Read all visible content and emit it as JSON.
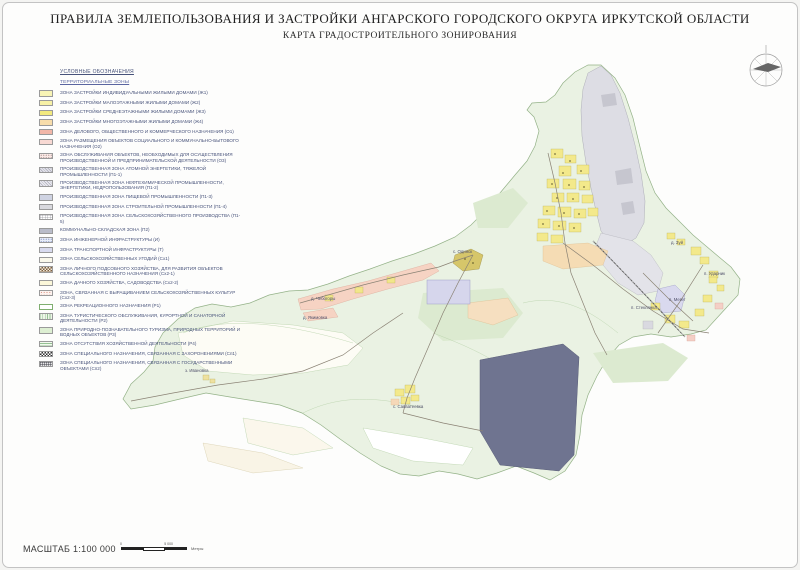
{
  "title": {
    "line1": "ПРАВИЛА ЗЕМЛЕПОЛЬЗОВАНИЯ И ЗАСТРОЙКИ АНГАРСКОГО ГОРОДСКОГО ОКРУГА ИРКУТСКОЙ ОБЛАСТИ",
    "line2": "КАРТА ГРАДОСТРОИТЕЛЬНОГО ЗОНИРОВАНИЯ"
  },
  "legend": {
    "heading": "УСЛОВНЫЕ ОБОЗНАЧЕНИЯ",
    "subheading": "ТЕРРИТОРИАЛЬНЫЕ ЗОНЫ",
    "items": [
      {
        "label": "ЗОНА ЗАСТРОЙКИ ИНДИВИДУАЛЬНЫМИ ЖИЛЫМИ ДОМАМИ (Ж1)",
        "color": "#f8f4b5",
        "pattern": "solid"
      },
      {
        "label": "ЗОНА ЗАСТРОЙКИ МАЛОЭТАЖНЫМИ ЖИЛЫМИ ДОМАМИ (Ж2)",
        "color": "#f7f1a6",
        "pattern": "solid"
      },
      {
        "label": "ЗОНА ЗАСТРОЙКИ СРЕДНЕЭТАЖНЫМИ ЖИЛЫМИ ДОМАМИ (Ж3)",
        "color": "#f2e97e",
        "pattern": "solid"
      },
      {
        "label": "ЗОНА ЗАСТРОЙКИ МНОГОЭТАЖНЫМИ ЖИЛЫМИ ДОМАМИ (Ж4)",
        "color": "#f7ddab",
        "pattern": "solid"
      },
      {
        "label": "ЗОНА ДЕЛОВОГО, ОБЩЕСТВЕННОГО И КОММЕРЧЕСКОГО НАЗНАЧЕНИЯ (О1)",
        "color": "#f2b7a8",
        "pattern": "solid"
      },
      {
        "label": "ЗОНА РАЗМЕЩЕНИЯ ОБЪЕКТОВ СОЦИАЛЬНОГО И КОММУНАЛЬНО-БЫТОВОГО НАЗНАЧЕНИЯ (О2)",
        "color": "#f8d9d3",
        "pattern": "solid"
      },
      {
        "label": "ЗОНА ОБСЛУЖИВАНИЯ ОБЪЕКТОВ, НЕОБХОДИМЫХ ДЛЯ ОСУЩЕСТВЛЕНИЯ ПРОИЗВОДСТВЕННОЙ И ПРЕДПРИНИМАТЕЛЬСКОЙ ДЕЯТЕЛЬНОСТИ (О3)",
        "color": "#fbeae6",
        "pattern": "dots"
      },
      {
        "label": "ПРОИЗВОДСТВЕННАЯ ЗОНА АТОМНОЙ ЭНЕРГЕТИКИ, ТЯЖЕЛОЙ ПРОМЫШЛЕННОСТИ (П1-1)",
        "color": "#e3e3ea",
        "pattern": "hatch"
      },
      {
        "label": "ПРОИЗВОДСТВЕННАЯ ЗОНА НЕФТЕХИМИЧЕСКОЙ ПРОМЫШЛЕННОСТИ, ЭНЕРГЕТИКИ, НЕДРОПОЛЬЗОВАНИЯ (П1-2)",
        "color": "#e9e9ef",
        "pattern": "hatch"
      },
      {
        "label": "ПРОИЗВОДСТВЕННАЯ ЗОНА ПИЩЕВОЙ ПРОМЫШЛЕННОСТИ (П1-3)",
        "color": "#cfd3e2",
        "pattern": "solid"
      },
      {
        "label": "ПРОИЗВОДСТВЕННАЯ ЗОНА СТРОИТЕЛЬНОЙ ПРОМЫШЛЕННОСТИ (П1-4)",
        "color": "#d9d9de",
        "pattern": "solid"
      },
      {
        "label": "ПРОИЗВОДСТВЕННАЯ ЗОНА СЕЛЬСКОХОЗЯЙСТВЕННОГО ПРОИЗВОДСТВА (П1-5)",
        "color": "#ffffff",
        "pattern": "grid"
      },
      {
        "label": "КОММУНАЛЬНО-СКЛАДСКАЯ ЗОНА (П2)",
        "color": "#b9bcc9",
        "pattern": "solid"
      },
      {
        "label": "ЗОНА ИНЖЕНЕРНОЙ ИНФРАСТРУКТУРЫ (И)",
        "color": "#e8edf8",
        "pattern": "dots-blue"
      },
      {
        "label": "ЗОНА ТРАНСПОРТНОЙ ИНФРАСТРУКТУРЫ (Т)",
        "color": "#d8daee",
        "pattern": "solid"
      },
      {
        "label": "ЗОНА СЕЛЬСКОХОЗЯЙСТВЕННЫХ УГОДИЙ (Сх1)",
        "color": "#faf8ea",
        "pattern": "solid"
      },
      {
        "label": "ЗОНА ЛИЧНОГО ПОДСОБНОГО ХОЗЯЙСТВА, ДЛЯ РАЗВИТИЯ ОБЪЕКТОВ СЕЛЬСКОХОЗЯЙСТВЕННОГО НАЗНАЧЕНИЯ (Сх2-1)",
        "color": "#f1e9d8",
        "pattern": "checker-brown"
      },
      {
        "label": "ЗОНА ДАЧНОГО ХОЗЯЙСТВА, САДОВОДСТВА (Сх2-2)",
        "color": "#fbf7d9",
        "pattern": "solid"
      },
      {
        "label": "ЗОНА, СВЯЗАННАЯ С ВЫРАЩИВАНИЕМ СЕЛЬСКОХОЗЯЙСТВЕННЫХ КУЛЬТУР (Сх2-3)",
        "color": "#fdf3ef",
        "pattern": "dots-red"
      },
      {
        "label": "ЗОНА РЕКРЕАЦИОННОГО НАЗНАЧЕНИЯ (Р1)",
        "color": "#ffffff",
        "pattern": "outline"
      },
      {
        "label": "ЗОНА ТУРИСТИЧЕСКОГО ОБСЛУЖИВАНИЯ, КУРОРТНОЙ И САНАТОРНОЙ ДЕЯТЕЛЬНОСТИ (Р2)",
        "color": "#eef6e8",
        "pattern": "vstripes"
      },
      {
        "label": "ЗОНА ПРИРОДНО-ПОЗНАВАТЕЛЬНОГО ТУРИЗМА, ПРИРОДНЫХ ТЕРРИТОРИЙ И ВОДНЫХ ОБЪЕКТОВ (Р3)",
        "color": "#ddefd2",
        "pattern": "solid"
      },
      {
        "label": "ЗОНА ОТСУТСТВИЯ ХОЗЯЙСТВЕННОЙ ДЕЯТЕЛЬНОСТИ (Р4)",
        "color": "#f2f9ee",
        "pattern": "hstripes"
      },
      {
        "label": "ЗОНА СПЕЦИАЛЬНОГО НАЗНАЧЕНИЯ, СВЯЗАННАЯ С ЗАХОРОНЕНИЯМИ (Сп1)",
        "color": "#ffffff",
        "pattern": "checker"
      },
      {
        "label": "ЗОНА СПЕЦИАЛЬНОГО НАЗНАЧЕНИЯ, СВЯЗАННАЯ С ГОСУДАРСТВЕННЫМИ ОБЪЕКТАМИ (Сп2)",
        "color": "#e8e8e8",
        "pattern": "grid-dark"
      }
    ]
  },
  "map": {
    "labels": [
      {
        "text": "д. Чебогоры",
        "x": 308,
        "y": 293
      },
      {
        "text": "д. Якимовка",
        "x": 300,
        "y": 312
      },
      {
        "text": "с. Одинск",
        "x": 450,
        "y": 246
      },
      {
        "text": "з. Ивановка",
        "x": 182,
        "y": 365
      },
      {
        "text": "с. Савватеевка",
        "x": 390,
        "y": 401
      },
      {
        "text": "д. Зуй",
        "x": 668,
        "y": 237
      },
      {
        "text": "п. Ударник",
        "x": 701,
        "y": 268
      },
      {
        "text": "п. Мегет",
        "x": 666,
        "y": 294
      },
      {
        "text": "п. Стеклянка",
        "x": 628,
        "y": 302
      }
    ],
    "zone_colors": {
      "district_fill": "#eaf2e3",
      "district_border": "#94b288",
      "industrial_gray": "#dddde4",
      "city_yellow": "#f3e98b",
      "peach": "#f5dcb4",
      "pink_strip": "#f6d3c3",
      "lavender": "#d6d6ec",
      "special_dark": "#6f7490",
      "cream": "#f9f4e6"
    }
  },
  "scale": {
    "label": "МАСШТАБ 1:100 000",
    "start": "0",
    "end": "5 000",
    "units": "Метры"
  }
}
